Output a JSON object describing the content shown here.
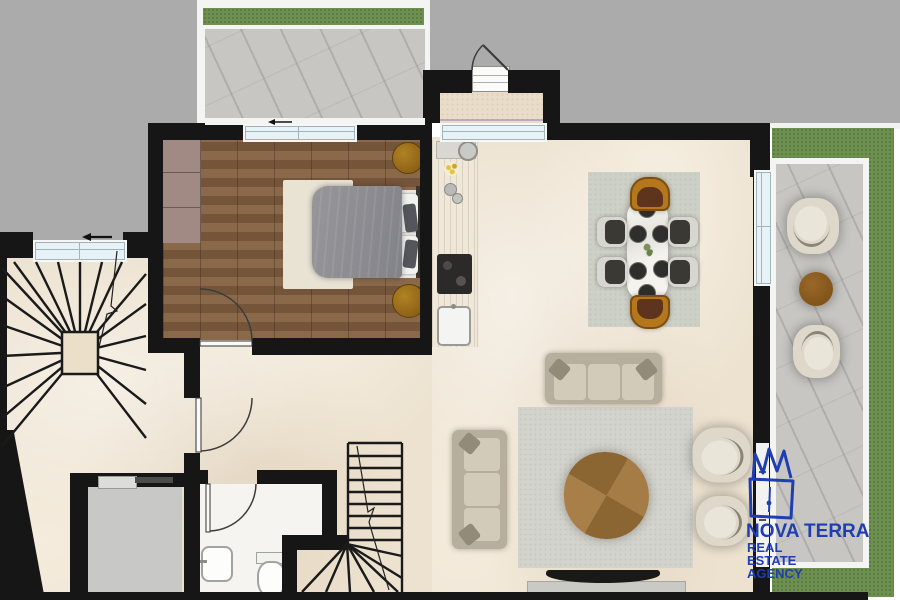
{
  "branding": {
    "agency_name": "NOVA TERRA",
    "agency_sub1": "REAL",
    "agency_sub2": "ESTATE",
    "agency_sub3": "AGENCY",
    "logo_icon": "crown-house-icon",
    "logo_color": "#1f3eb0"
  },
  "palette": {
    "wall_black": "#161616",
    "exterior_gray": "#ababab",
    "marble_floor": "#ede2d0",
    "wood_floor": "#7d5d41",
    "grass_green": "#6d8f50",
    "concrete_gray": "#c7c6c3",
    "window_glass": "#e6f2f5",
    "wardrobe_mauve": "#a18984",
    "nightstand_gold": "#96661a",
    "sofa_beige": "#b7af9e",
    "coffee_table_wood": "#a57c45",
    "dining_chair_dark": "#3a3934",
    "dining_chair_gold": "#b5771c",
    "bed_duvet_gray": "#8e8e91",
    "elevator_gray": "#c8c8c6"
  }
}
